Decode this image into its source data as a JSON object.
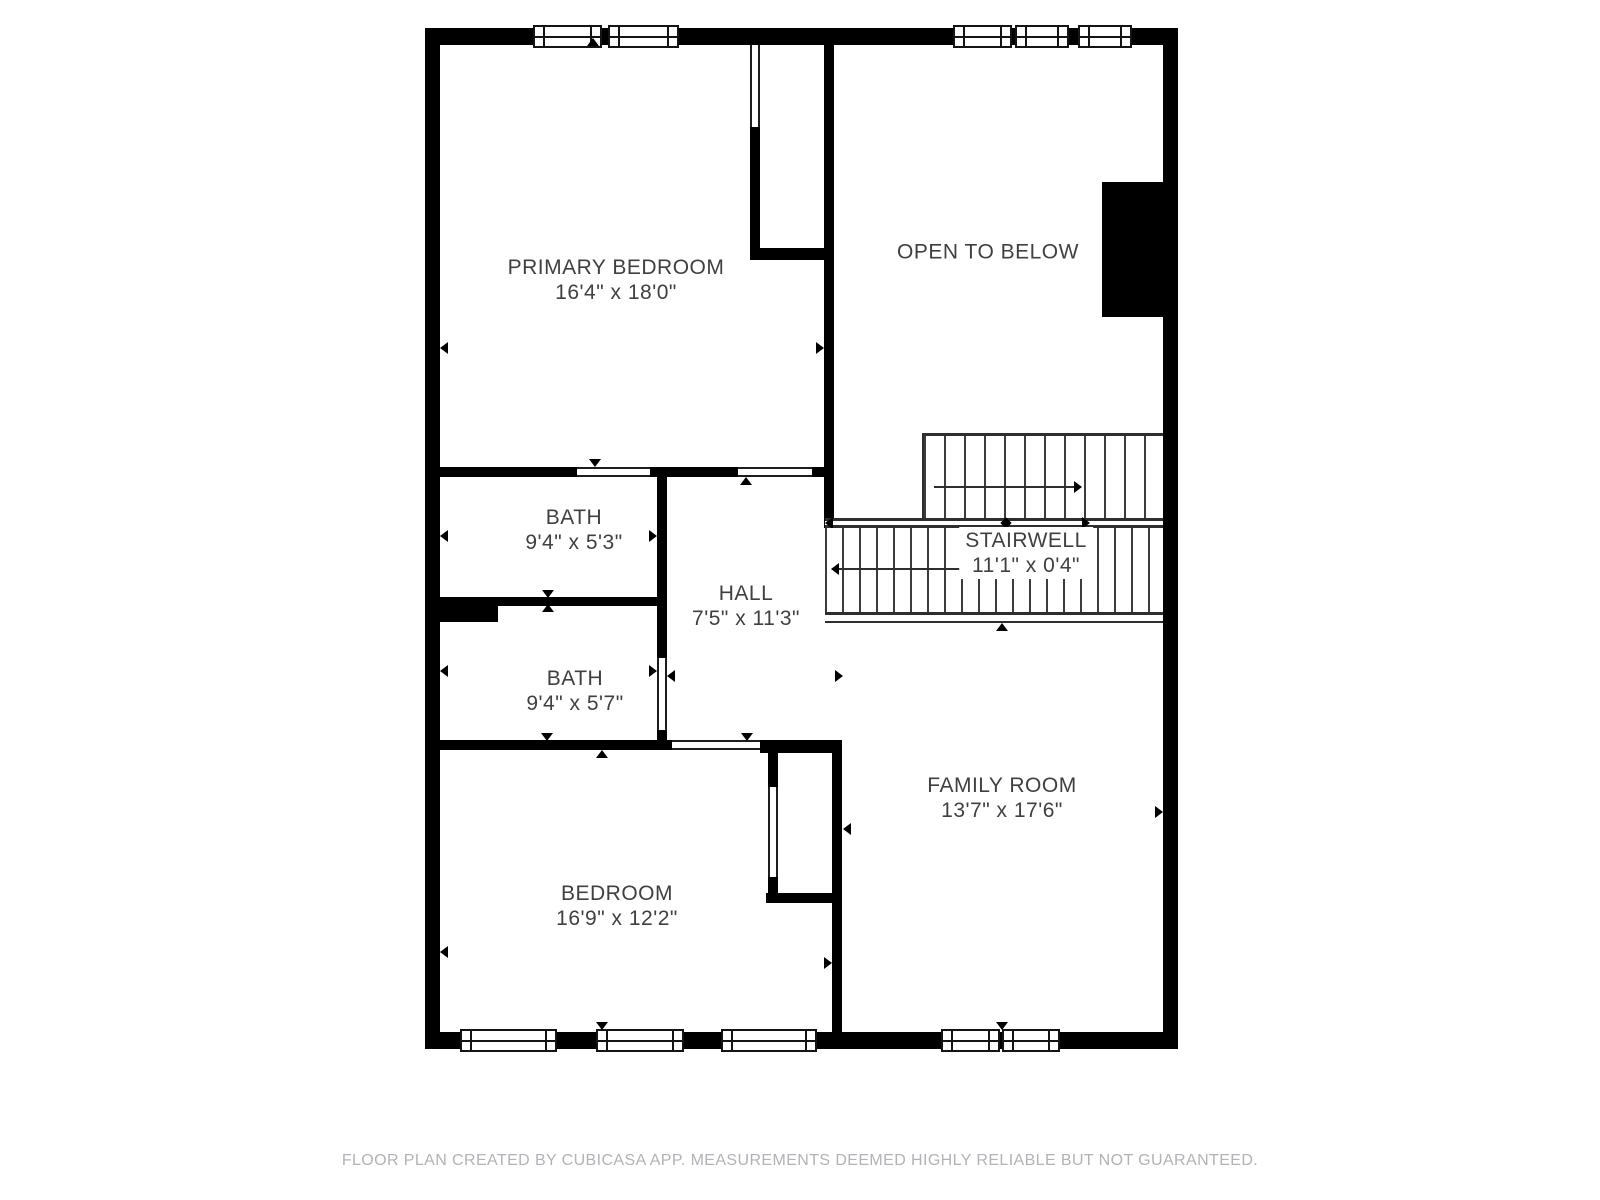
{
  "floorplan": {
    "rooms": [
      {
        "label": "PRIMARY BEDROOM",
        "dims": "16'4\" x 18'0\""
      },
      {
        "label": "OPEN TO BELOW",
        "dims": ""
      },
      {
        "label": "BATH",
        "dims": "9'4\" x 5'3\""
      },
      {
        "label": "HALL",
        "dims": "7'5\" x 11'3\""
      },
      {
        "label": "STAIRWELL",
        "dims": "11'1\" x 0'4\""
      },
      {
        "label": "BATH",
        "dims": "9'4\" x 5'7\""
      },
      {
        "label": "BEDROOM",
        "dims": "16'9\" x 12'2\""
      },
      {
        "label": "FAMILY ROOM",
        "dims": "13'7\" x 17'6\""
      }
    ],
    "footer": "FLOOR PLAN CREATED BY CUBICASA APP. MEASUREMENTS DEEMED HIGHLY RELIABLE BUT NOT GUARANTEED.",
    "colors": {
      "wall": "#000000",
      "stair_line": "#3c3c3c",
      "label_text": "#404040",
      "footer_text": "#b2b2b7",
      "background": "#ffffff"
    }
  }
}
